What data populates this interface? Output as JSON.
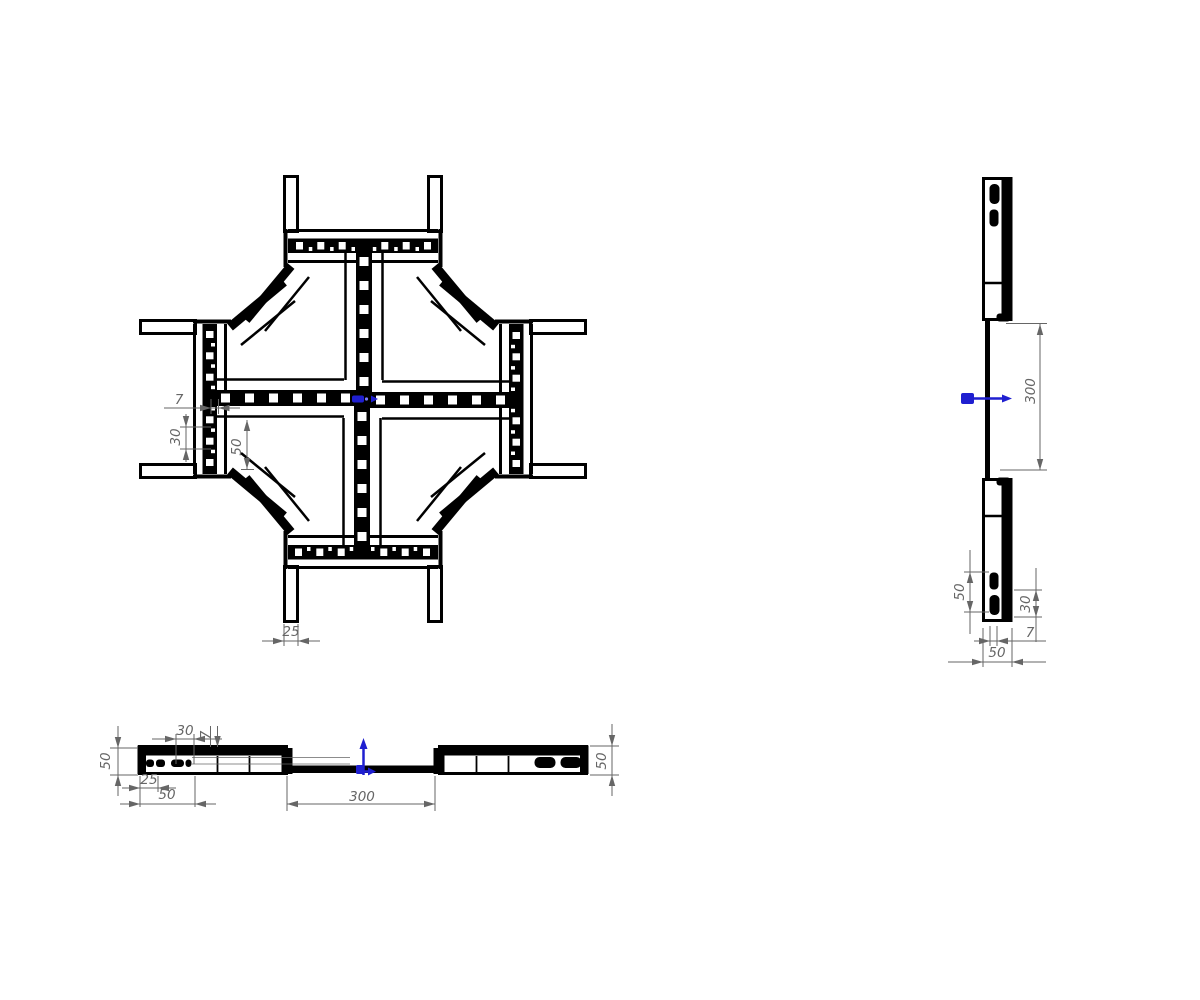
{
  "colors": {
    "background": "#ffffff",
    "drawing_line": "#000000",
    "dimension": "#666666",
    "datum_blue": "#1f1fd0"
  },
  "views": {
    "plan": {
      "d7": "7",
      "d30": "30",
      "d50": "50",
      "d25": "25"
    },
    "side": {
      "d300": "300",
      "d50_slots": "50",
      "d30": "30",
      "d7": "7",
      "d50_width": "50"
    },
    "front": {
      "d50_left": "50",
      "d30": "30",
      "d7": "7",
      "d25": "25",
      "d50_slot": "50",
      "d300": "300",
      "d50_right": "50"
    }
  }
}
